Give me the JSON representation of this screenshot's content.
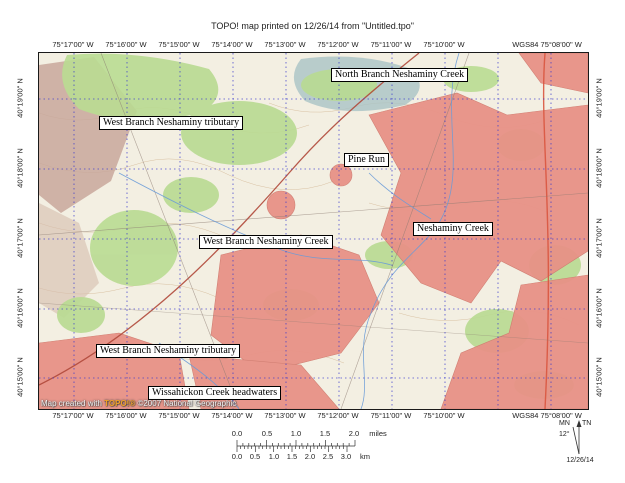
{
  "title": "TOPO! map printed on 12/26/14 from \"Untitled.tpo\"",
  "axes": {
    "top_labels": [
      {
        "t": "75°17'00\" W",
        "x": 73
      },
      {
        "t": "75°16'00\" W",
        "x": 126
      },
      {
        "t": "75°15'00\" W",
        "x": 179
      },
      {
        "t": "75°14'00\" W",
        "x": 232
      },
      {
        "t": "75°13'00\" W",
        "x": 285
      },
      {
        "t": "75°12'00\" W",
        "x": 338
      },
      {
        "t": "75°11'00\" W",
        "x": 391
      },
      {
        "t": "75°10'00\" W",
        "x": 444
      },
      {
        "t": "WGS84 75°08'00\" W",
        "x": 547
      }
    ],
    "bottom_labels": [
      {
        "t": "75°17'00\" W",
        "x": 73
      },
      {
        "t": "75°16'00\" W",
        "x": 126
      },
      {
        "t": "75°15'00\" W",
        "x": 179
      },
      {
        "t": "75°14'00\" W",
        "x": 232
      },
      {
        "t": "75°13'00\" W",
        "x": 285
      },
      {
        "t": "75°12'00\" W",
        "x": 338
      },
      {
        "t": "75°11'00\" W",
        "x": 391
      },
      {
        "t": "75°10'00\" W",
        "x": 444
      },
      {
        "t": "WGS84 75°08'00\" W",
        "x": 547
      }
    ],
    "left_labels": [
      {
        "t": "40°19'00\" N",
        "y": 98
      },
      {
        "t": "40°18'00\" N",
        "y": 168
      },
      {
        "t": "40°17'00\" N",
        "y": 238
      },
      {
        "t": "40°16'00\" N",
        "y": 308
      },
      {
        "t": "40°15'00\" N",
        "y": 377
      }
    ],
    "right_labels": [
      {
        "t": "40°19'00\" N",
        "y": 98
      },
      {
        "t": "40°18'00\" N",
        "y": 168
      },
      {
        "t": "40°17'00\" N",
        "y": 238
      },
      {
        "t": "40°16'00\" N",
        "y": 308
      },
      {
        "t": "40°15'00\" N",
        "y": 377
      }
    ]
  },
  "grid": {
    "vertical_x": [
      35,
      88,
      141,
      194,
      247,
      300,
      353,
      406,
      459,
      512
    ],
    "horizontal_y": [
      46,
      116,
      186,
      256,
      325
    ],
    "color": "#3a3ace"
  },
  "map_labels": [
    {
      "t": "North Branch Neshaminy Creek",
      "x": 292,
      "y": 15
    },
    {
      "t": "West Branch Neshaminy tributary",
      "x": 60,
      "y": 63
    },
    {
      "t": "Pine Run",
      "x": 305,
      "y": 100
    },
    {
      "t": "West Branch Neshaminy Creek",
      "x": 160,
      "y": 182
    },
    {
      "t": "Neshaminy Creek",
      "x": 374,
      "y": 169
    },
    {
      "t": "West Branch Neshaminy tributary",
      "x": 57,
      "y": 291
    },
    {
      "t": "Wissahickon Creek headwaters",
      "x": 109,
      "y": 333
    }
  ],
  "attribution": {
    "prefix": "Map created with ",
    "brand": "TOPO!®",
    "suffix": " ©2007 National Geographic"
  },
  "scale_bar": {
    "miles_labels": [
      {
        "t": "0.0",
        "x": 9
      },
      {
        "t": "0.5",
        "x": 39
      },
      {
        "t": "1.0",
        "x": 68
      },
      {
        "t": "1.5",
        "x": 97
      },
      {
        "t": "2.0",
        "x": 126
      },
      {
        "t": "miles",
        "x": 150
      }
    ],
    "km_labels": [
      {
        "t": "0.0",
        "x": 9
      },
      {
        "t": "0.5",
        "x": 27
      },
      {
        "t": "1.0",
        "x": 46
      },
      {
        "t": "1.5",
        "x": 64
      },
      {
        "t": "2.0",
        "x": 82
      },
      {
        "t": "2.5",
        "x": 100
      },
      {
        "t": "3.0",
        "x": 118
      },
      {
        "t": "km",
        "x": 137
      }
    ]
  },
  "declination": {
    "mn": "MN",
    "tn": "TN",
    "angle": "12°",
    "date": "12/26/14"
  },
  "colors": {
    "urban": "#e89287",
    "forest": "#b9db92",
    "water": "#6a9bd8",
    "ridge": "#c8a79b"
  }
}
